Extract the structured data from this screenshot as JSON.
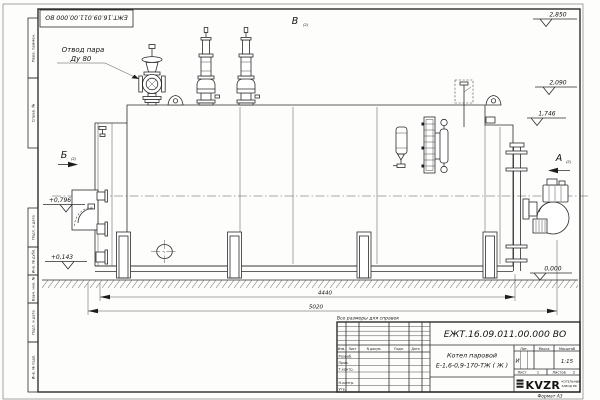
{
  "meta": {
    "doc_number": "ЕЖТ.16.09.011.00.000 ВО",
    "format_note": "Формат А3",
    "reference_note": "Все размеры для справок"
  },
  "callout": {
    "line1": "Отвод пара",
    "line2": "Ду 80"
  },
  "views": {
    "v": "В",
    "b": "Б",
    "a": "А",
    "sheet_ref": "(2)"
  },
  "elevations": {
    "e2850": "2,850",
    "e2090": "2,090",
    "e1746": "1,746",
    "e0000": "0,000",
    "e0796": "+0,796",
    "e0143": "+0,143"
  },
  "dimensions": {
    "d4440": "4440",
    "d5020": "5020"
  },
  "margins": {
    "m1": "Перв. примен.",
    "m2": "Справ. №",
    "m3": "Подп. и дата",
    "m4": "Инв. № дубл.",
    "m5": "Взам. инв. №",
    "m6": "Подп. и дата",
    "m7": "Инв. № подл."
  },
  "title_block": {
    "product_name": "Котел паровой",
    "product_model": "Е-1,6-0,9-170-ТЖ ( Ж )",
    "col_izm": "Изм.",
    "col_list": "Лист",
    "col_doc": "N докум.",
    "col_sign": "Подп.",
    "col_date": "Дата",
    "row_razrab": "Разраб.",
    "row_prov": "Пров.",
    "row_tkontr": "Т.контр.",
    "row_nkontr": "Н.контр.",
    "row_utv": "Утв.",
    "lit_header": "Лит.",
    "mass_header": "Масса",
    "scale_header": "Масштаб",
    "lit_value": "И",
    "scale_value": "1:15",
    "sheet_label": "Лист",
    "sheet_num": "1",
    "sheets_label": "Листов",
    "sheets_num": "2",
    "logo": "KVZR",
    "logo_sub1": "КОТЕЛЬНЫЙ",
    "logo_sub2": "ЗАВОД РФ"
  }
}
